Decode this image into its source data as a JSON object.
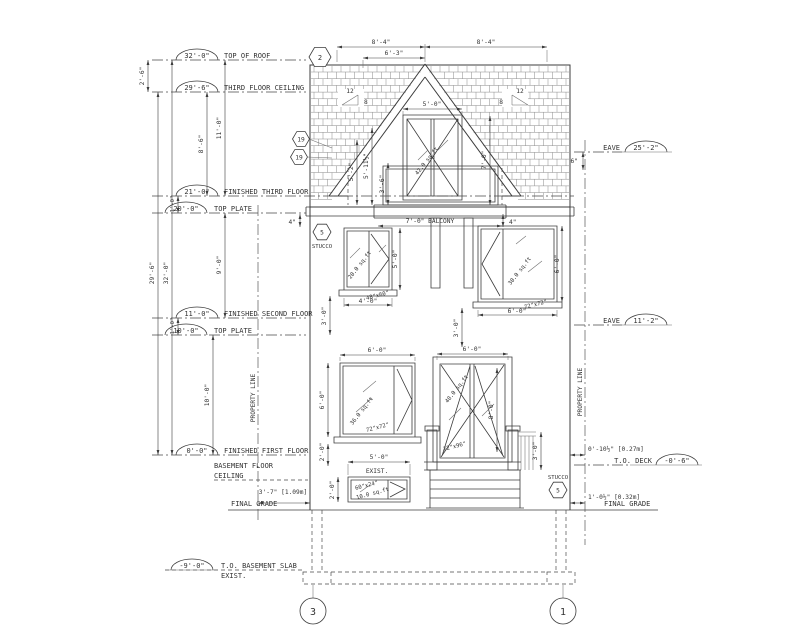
{
  "levels": [
    {
      "elev": "32'-0\"",
      "name": "TOP OF ROOF"
    },
    {
      "elev": "29'-6\"",
      "name": "THIRD FLOOR CEILING"
    },
    {
      "elev": "21'-0\"",
      "name": "FINISHED THIRD FLOOR"
    },
    {
      "elev": "20'-0\"",
      "name": "TOP PLATE"
    },
    {
      "elev": "11'-0\"",
      "name": "FINISHED SECOND FLOOR"
    },
    {
      "elev": "10'-0\"",
      "name": "TOP PLATE"
    },
    {
      "elev": "0'-0\"",
      "name": "FINISHED FIRST FLOOR"
    },
    {
      "name": "BASEMENT FLOOR",
      "name2": "CEILING"
    },
    {
      "elev": "-9'-0\"",
      "name": "T.O. BASEMENT SLAB",
      "name2": "EXIST."
    }
  ],
  "grade": {
    "left": "FINAL GRADE",
    "right": "FINAL GRADE"
  },
  "eaves": {
    "upper": {
      "label": "EAVE",
      "elev": "25'-2\""
    },
    "lower": {
      "label": "EAVE",
      "elev": "11'-2\""
    }
  },
  "deck": {
    "label": "T.O. DECK",
    "elev": "-0'-6\""
  },
  "property_line": "PROPERTY LINE",
  "vdims": {
    "gap_roof": "2'-6\"",
    "ceil_to_first": "29'-6\"",
    "total": "32'-0\"",
    "third": "8'-6\"",
    "roof_third": "11'-0\"",
    "second": "9'-0\"",
    "first": "10'-0\"",
    "plate_upper": "1'-0\"",
    "plate_lower": "1'-0\""
  },
  "topdims": {
    "left": "8'-4\"",
    "right": "8'-4\"",
    "inner": "6'-3\""
  },
  "dormer": {
    "width": "5'-0\"",
    "h1": "5'-2\"",
    "h2": "5'-11½\"",
    "rail": "3'-6\"",
    "height": "7'-0\"",
    "balcony": "7'-0\" BALCONY",
    "area": "42.0 sq.ft",
    "slope_run": "12",
    "slope_rise": "8"
  },
  "win2l": {
    "area": "20.0 sq.ft",
    "size": "48\"x60\"",
    "w": "4'-0\"",
    "h": "5'-0\"",
    "sill": "3'-0\""
  },
  "win2r": {
    "area": "30.0 sq.ft",
    "size": "72\"x72\"",
    "w": "6'-0\"",
    "h": "6'-0\"",
    "sill": "3'-0\"",
    "overhang": "4\""
  },
  "win1l": {
    "area": "36.0 sq.ft",
    "size": "72\"x72\"",
    "w": "6'-0\"",
    "h": "6'-0\"",
    "sill": "2'-0\""
  },
  "door": {
    "area": "48.0 sq.ft",
    "size": "72\"x96\"",
    "w": "6'-0\"",
    "h": "8'-0\"",
    "rail": "3'-0\""
  },
  "bwin": {
    "exist": "EXIST.",
    "w": "5'-0\"",
    "size": "60\"x24\"",
    "area": "10.0 sq.ft",
    "h": "2'-0\""
  },
  "offsets": {
    "left": "3'-7\" [1.09m]",
    "deck": "0'-10½\" [0.27m]",
    "grade": "1'-0½\" [0.32m]",
    "eave": "6\"",
    "overhang_left": "4\""
  },
  "keynotes": {
    "top": "2",
    "k19a": "19",
    "k19b": "19",
    "stucco_num": "5",
    "stucco": "STUCCO"
  },
  "grid": {
    "left": "3",
    "right": "1"
  }
}
